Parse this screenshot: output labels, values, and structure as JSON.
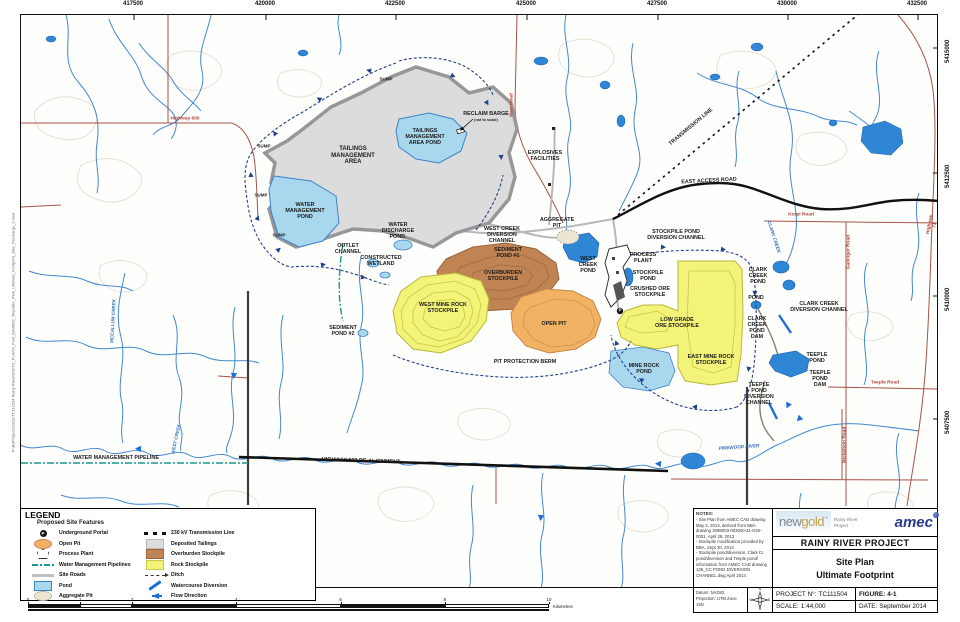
{
  "figure": {
    "width": 960,
    "height": 622
  },
  "filepath": "P:\\BBProjects\\2011\\TC111504 Rainy River\\GIS\\TC_PLANS_Post_EA\\9892_Map\\Site_Plan_Ultimate_Footprint_date_Discharge_2.mxd",
  "colors": {
    "pond_light": "#a9d7ee",
    "pond_dark": "#2f86d4",
    "tailings": "#dcdcdc",
    "overburden": "#c08454",
    "rock_stockpile": "#f3f37a",
    "open_pit": "#f2b264",
    "stream": "#4189cf",
    "road_red": "#a85248",
    "pipeline_teal": "#18998f",
    "ditch_navy": "#24408c",
    "amec_blue": "#2b3990",
    "newgold_gold": "#c3a04c"
  },
  "map": {
    "grid": {
      "top": [
        {
          "v": "417500",
          "x": 133
        },
        {
          "v": "420000",
          "x": 265
        },
        {
          "v": "422500",
          "x": 395
        },
        {
          "v": "425000",
          "x": 526
        },
        {
          "v": "427500",
          "x": 657
        },
        {
          "v": "430000",
          "x": 787
        },
        {
          "v": "432500",
          "x": 917
        }
      ],
      "right": [
        {
          "v": "5415000",
          "y": 47
        },
        {
          "v": "5412500",
          "y": 172
        },
        {
          "v": "5410000",
          "y": 295
        },
        {
          "v": "5407500",
          "y": 418
        }
      ]
    },
    "labels": [
      {
        "t": "SUMP",
        "x": 365,
        "y": 64,
        "size": 4.5
      },
      {
        "t": "SUMP",
        "x": 243,
        "y": 131,
        "size": 4.5
      },
      {
        "t": "SUMP",
        "x": 240,
        "y": 180,
        "size": 4.5
      },
      {
        "t": "SUMP",
        "x": 258,
        "y": 220,
        "size": 4.5
      },
      {
        "t": "TAILINGS\nMANAGEMENT\nAREA",
        "x": 332,
        "y": 141,
        "cls": "big"
      },
      {
        "t": "TAILINGS\nMANAGEMENT\nAREA POND",
        "x": 404,
        "y": 122
      },
      {
        "t": "RECLAIM BARGE",
        "x": 465,
        "y": 99
      },
      {
        "t": "(not to scale)",
        "x": 465,
        "y": 105,
        "size": 3.8
      },
      {
        "t": "WATER\nMANAGEMENT\nPOND",
        "x": 284,
        "y": 196
      },
      {
        "t": "OUTLET\nCHANNEL",
        "x": 327,
        "y": 234
      },
      {
        "t": "WATER\nDISCHARGE\nPOND.",
        "x": 377,
        "y": 216
      },
      {
        "t": "CONSTRUCTED\nWETLAND",
        "x": 360,
        "y": 246
      },
      {
        "t": "WEST CREEK\nDIVERSION\nCHANNEL",
        "x": 481,
        "y": 220
      },
      {
        "t": "SEDIMENT\nPOND #1",
        "x": 487,
        "y": 238
      },
      {
        "t": "AGGREGATE\nPIT",
        "x": 536,
        "y": 208
      },
      {
        "t": "EXPLOSIVES\nFACILITIES",
        "x": 524,
        "y": 141
      },
      {
        "t": "OVERBURDEN\nSTOCKPILE",
        "x": 482,
        "y": 261
      },
      {
        "t": "WEST MINE ROCK\nSTOCKPILE",
        "x": 422,
        "y": 293
      },
      {
        "t": "OPEN PIT",
        "x": 533,
        "y": 309
      },
      {
        "t": "PIT PROTECTION BERM",
        "x": 504,
        "y": 347
      },
      {
        "t": "WEST\nCREEK\nPOND",
        "x": 567,
        "y": 250
      },
      {
        "t": "PROCESS\nPLANT",
        "x": 622,
        "y": 243
      },
      {
        "t": "STOCKPILE\nPOND",
        "x": 627,
        "y": 261
      },
      {
        "t": "CRUSHED ORE\nSTOCKPILE",
        "x": 629,
        "y": 277
      },
      {
        "t": "STOCKPILE POND\nDIVERSION CHANNEL",
        "x": 655,
        "y": 220
      },
      {
        "t": "LOW GRADE\nORE STOCKPILE",
        "x": 656,
        "y": 308
      },
      {
        "t": "EAST MINE ROCK\nSTOCKPILE",
        "x": 690,
        "y": 345
      },
      {
        "t": "MINE ROCK\nPOND",
        "x": 623,
        "y": 354
      },
      {
        "t": "CLARK\nCREEK\nPOND",
        "x": 737,
        "y": 261
      },
      {
        "t": "POND",
        "x": 735,
        "y": 283
      },
      {
        "t": "CLARK\nCREEK\nPOND\nDAM",
        "x": 736,
        "y": 313
      },
      {
        "t": "CLARK CREEK\nDIVERSION CHANNEL",
        "x": 798,
        "y": 292
      },
      {
        "t": "TEEPLE\nPOND",
        "x": 796,
        "y": 343
      },
      {
        "t": "TEEPLE\nPOND\nDAM",
        "x": 799,
        "y": 364
      },
      {
        "t": "TEEPLE\nPOND\nDIVERSION\nCHANNEL",
        "x": 738,
        "y": 379
      },
      {
        "t": "EAST ACCESS ROAD",
        "x": 688,
        "y": 166,
        "rot": -3
      },
      {
        "t": "TRANSMISSION LINE",
        "x": 670,
        "y": 112,
        "rot": -40
      },
      {
        "t": "HIGHWAY 600 RE-ALIGNMENT",
        "x": 340,
        "y": 446,
        "rot": 2
      },
      {
        "t": "WATER MANAGEMENT PIPELINE",
        "x": 95,
        "y": 443
      },
      {
        "t": "SEDIMENT\nPOND #2",
        "x": 322,
        "y": 316
      },
      {
        "t": "P",
        "x": 599,
        "y": 296,
        "cls": "portal"
      },
      {
        "t": "Highway 600",
        "x": 164,
        "y": 104,
        "cls": "road"
      },
      {
        "t": "Highway 71",
        "x": 912,
        "y": 210,
        "cls": "road",
        "rot": -80
      },
      {
        "t": "Marr Road",
        "x": 491,
        "y": 90,
        "cls": "road",
        "rot": -90
      },
      {
        "t": "Korpi Road",
        "x": 780,
        "y": 200,
        "cls": "road"
      },
      {
        "t": "Gallinger Road",
        "x": 828,
        "y": 237,
        "cls": "road",
        "rot": -90
      },
      {
        "t": "Teeple Road",
        "x": 864,
        "y": 368,
        "cls": "road"
      },
      {
        "t": "Mickelson Road",
        "x": 824,
        "y": 430,
        "cls": "road",
        "rot": -90
      },
      {
        "t": "CLARK CREEK",
        "x": 753,
        "y": 222,
        "cls": "water",
        "rot": 72
      },
      {
        "t": "MCCALLUM CREEK",
        "x": 92,
        "y": 306,
        "cls": "water",
        "rot": -87
      },
      {
        "t": "WEST CREEK",
        "x": 155,
        "y": 424,
        "cls": "water",
        "rot": -78
      },
      {
        "t": "PINEWOOD RIVER",
        "x": 718,
        "y": 432,
        "cls": "water",
        "rot": -4
      }
    ]
  },
  "legend": {
    "title": "LEGEND",
    "subtitle": "Proposed Site Features",
    "col1": [
      {
        "icon": "portal",
        "glyph": "P",
        "label": "Underground Portal"
      },
      {
        "icon": "openpit",
        "label": "Open Pit"
      },
      {
        "icon": "plant",
        "label": "Process Plant"
      },
      {
        "icon": "pipe",
        "label": "Water Management Pipelines"
      },
      {
        "icon": "road",
        "label": "Site Roads"
      },
      {
        "icon": "pond",
        "label": "Pond"
      },
      {
        "icon": "agg",
        "label": "Aggregate Pit"
      }
    ],
    "col2": [
      {
        "icon": "trans",
        "label": "230 kV Transmission Line"
      },
      {
        "icon": "tail",
        "label": "Deposited Tailings"
      },
      {
        "icon": "over",
        "label": "Overburden Stockpile"
      },
      {
        "icon": "rock",
        "label": "Rock Stockpile"
      },
      {
        "icon": "ditch",
        "label": "Ditch"
      },
      {
        "icon": "div",
        "label": "Watercourse Diversion"
      },
      {
        "icon": "flow",
        "label": "Flow Direction"
      }
    ]
  },
  "scalebar": {
    "ticks": [
      {
        "label": "0",
        "km": 0
      },
      {
        "label": "1",
        "km": 1
      },
      {
        "label": "2",
        "km": 2
      },
      {
        "label": "4",
        "km": 4
      },
      {
        "label": "6",
        "km": 6
      },
      {
        "label": "8",
        "km": 8
      },
      {
        "label": "10",
        "km": 10
      }
    ],
    "px_per_km": 52.1,
    "unit": "Kilometres"
  },
  "notes": {
    "header": "NOTES:",
    "lines": [
      "- Site Plan from AMEC CAD drawing May 3, 2013, derived from BBA drawing 3098003-003000-41-D20-0001, April 29, 2013",
      "- Stockpile modification provided by BBA, Sept 30, 2013",
      "- Stockpile pond/diversion, Clark Cr. pond/diversion and Teeple pond/ information from AMEC CAD drawing 135_CC POND DIVERSION CHANNEL.dwg April 2014"
    ]
  },
  "datum": {
    "line1": "Datum: NAD83",
    "line2": "Projection: UTM Zone 15N"
  },
  "compass": {
    "points": [
      "N",
      "E",
      "S",
      "W"
    ]
  },
  "brand": {
    "newgold_new": "new",
    "newgold_gold": "gold",
    "tm": "™",
    "tagline": "Rainy River Project",
    "amec": "amec"
  },
  "titleblock": {
    "project": "RAINY RIVER PROJECT",
    "title1": "Site Plan",
    "title2": "Ultimate Footprint",
    "project_no_label": "PROJECT N°:",
    "project_no": "TC111504",
    "figure_label": "FIGURE:",
    "figure": "4-1",
    "scale_label": "SCALE:",
    "scale": "1:44,000",
    "date_label": "DATE:",
    "date": "September 2014"
  }
}
